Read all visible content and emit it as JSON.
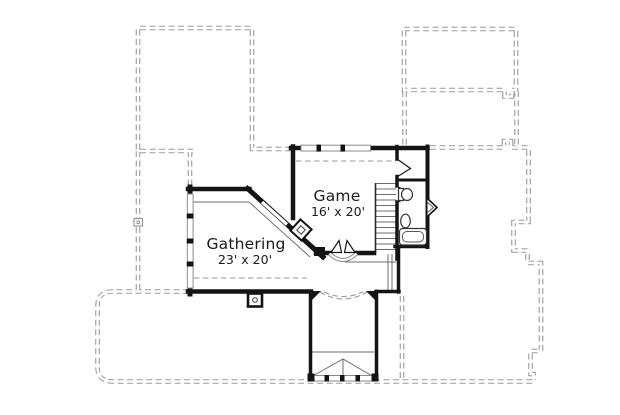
{
  "rooms": [
    {
      "name": "Game",
      "dims": "16' x 20'"
    },
    {
      "name": "Gathering",
      "dims": "23' x 20'"
    }
  ],
  "colors": {
    "wall": "#141414",
    "roof_dash": "#9a9a9a",
    "window_frame": "#8a8a8a",
    "thin_line": "#6e6e6e",
    "text": "#1a1a1a",
    "background": "#ffffff"
  }
}
